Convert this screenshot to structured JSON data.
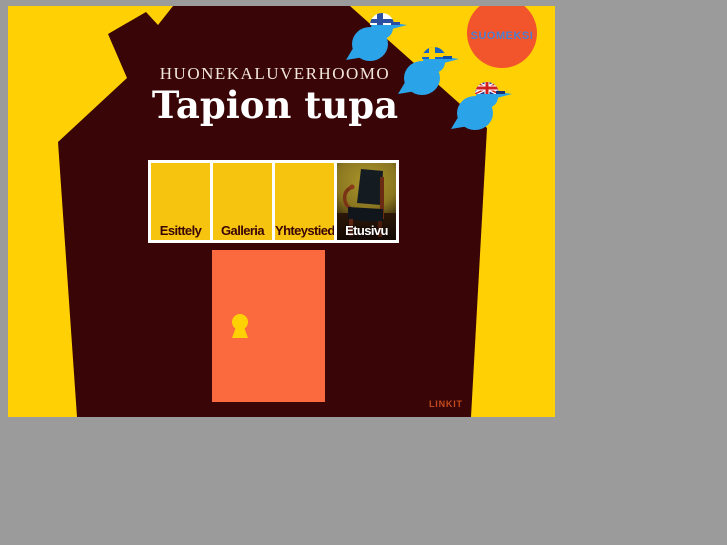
{
  "colors": {
    "page_background": "#9b9b9b",
    "site_background": "#ffd104",
    "house": "#3a0506",
    "door": "#fb6a3e",
    "keyhole": "#ffd104",
    "language_circle": "#f2552b",
    "language_circle_text": "#4a7fd0",
    "bird_blue": "#2ba3e8",
    "nav_tile_yellow": "#f6c40e",
    "nav_label_brown": "#3a0506",
    "links_label_color": "#c24a1c",
    "title_color": "#ffffff",
    "tagline_color": "#f2e8da"
  },
  "header": {
    "tagline": "HUONEKALUVERHOOMO",
    "title": "Tapion tupa"
  },
  "language": {
    "circle_label": "SUOMEKSI",
    "birds": [
      {
        "id": "finnish-flag-cap-bird",
        "flag": "Finland"
      },
      {
        "id": "swedish-flag-cap-bird",
        "flag": "Sweden"
      },
      {
        "id": "union-jack-cap-bird",
        "flag": "United Kingdom"
      }
    ]
  },
  "nav": {
    "items": [
      {
        "label": "Esittely"
      },
      {
        "label": "Galleria"
      },
      {
        "label": "Yhteystied."
      },
      {
        "label": "Etusivu"
      }
    ]
  },
  "footer": {
    "links_label": "LINKIT"
  }
}
